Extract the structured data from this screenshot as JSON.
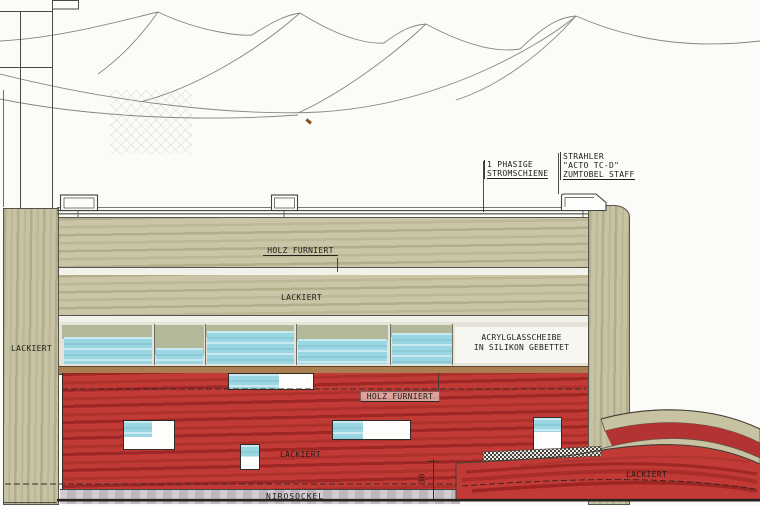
{
  "labels": {
    "power_track": {
      "line1": "1 PHASIGE",
      "line2": "STROMSCHIENE"
    },
    "spotlight": {
      "line1": "STRAHLER",
      "line2": "\"ACTO TC-D\"",
      "line3": "ZUMTOBEL STAFF"
    },
    "upper_band_veneer": "HOLZ FURNIERT",
    "upper_band_lacquer": "LACKIERT",
    "glass": {
      "line1": "ACRYLGLASSCHEIBE",
      "line2": "IN SILIKON GEBETTET"
    },
    "lower_band_veneer": "HOLZ FURNIERT",
    "lower_band_lacquer": "LACKIERT",
    "left_column_lacquer": "LACKIERT",
    "curved_wall_lacquer": "LACKIERT",
    "base": "NIROSOCKEL",
    "dimension_30": "30"
  },
  "colors": {
    "wood_beige": "#c9c5a6",
    "lacquer_red": "#c23a35",
    "acrylic_cyan": "#9bd7e2",
    "steel_base_grey": "#bdb7bd",
    "sill_brown": "#aa7e50",
    "paper_white": "#fbfbf8",
    "line_grey": "#4a4a46"
  }
}
